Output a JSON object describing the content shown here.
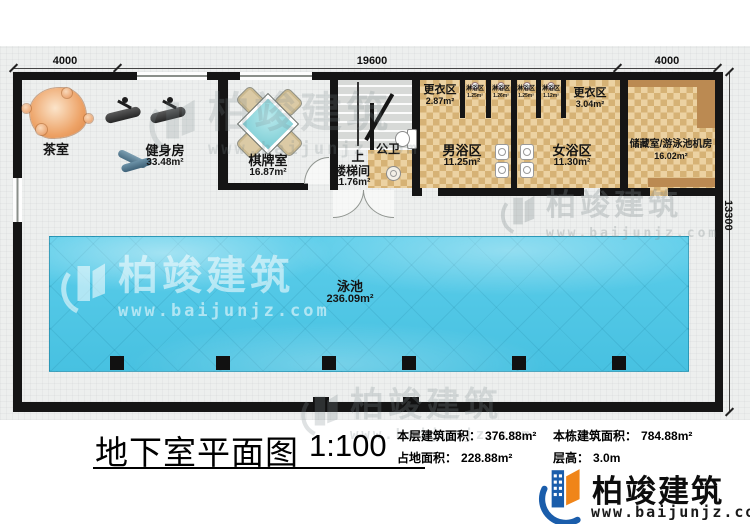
{
  "plan": {
    "dims": {
      "top_left": "4000",
      "top_mid": "19600",
      "top_right": "4000",
      "right": "13300"
    },
    "rooms": {
      "tea": {
        "name": "茶室"
      },
      "gym": {
        "name": "健身房",
        "area": "33.48m²"
      },
      "chess": {
        "name": "棋牌室",
        "area": "16.87m²"
      },
      "stair": {
        "name": "楼梯间",
        "area": "11.76m²",
        "dir": "上"
      },
      "toilet": {
        "name": "公卫"
      },
      "change1": {
        "name": "更衣区",
        "area": "2.87m²"
      },
      "shower1": {
        "name": "淋浴区",
        "area": "1.25m²"
      },
      "shower2": {
        "name": "淋浴区",
        "area": "1.26m²"
      },
      "shower3": {
        "name": "淋浴区",
        "area": "1.25m²"
      },
      "shower4": {
        "name": "淋浴区",
        "area": "1.12m²"
      },
      "change2": {
        "name": "更衣区",
        "area": "3.04m²"
      },
      "male": {
        "name": "男浴区",
        "area": "11.25m²"
      },
      "female": {
        "name": "女浴区",
        "area": "11.30m²"
      },
      "storage": {
        "name": "储藏室/游泳池机房",
        "area": "16.02m²"
      },
      "pool": {
        "name": "泳池",
        "area": "236.09m²"
      }
    }
  },
  "title_block": {
    "title": "地下室平面图",
    "scale": "1:100",
    "stats": [
      {
        "label": "本层建筑面积：",
        "value": "376.88m²"
      },
      {
        "label": "本栋建筑面积：",
        "value": "784.88m²"
      },
      {
        "label": "占地面积：",
        "value": "228.88m²"
      },
      {
        "label": "层高：",
        "value": "3.0m"
      }
    ]
  },
  "brand": {
    "name": "柏竣建筑",
    "url": "www.baijunjz.com"
  },
  "watermark": {
    "name": "柏竣建筑",
    "url": "www.baijunjz.com"
  },
  "colors": {
    "wall": "#151515",
    "pool": "#4fc6e4",
    "tile_light": "#ecd2a2",
    "tile_dark": "#d6b275",
    "brand_blue": "#1a5dab",
    "brand_orange": "#f08519"
  }
}
